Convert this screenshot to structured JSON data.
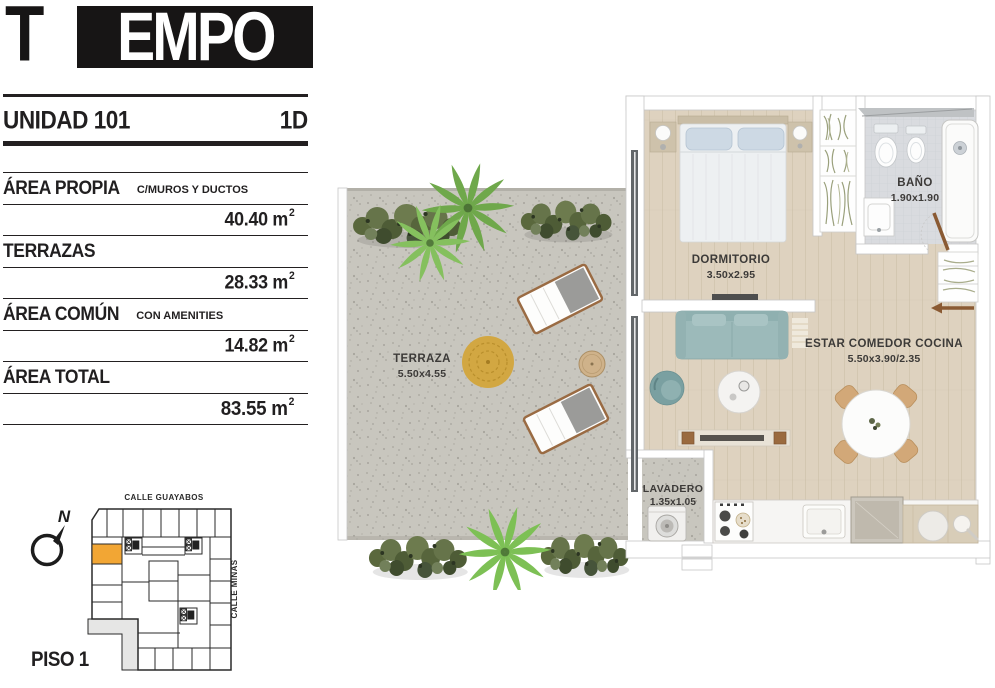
{
  "brand": {
    "logo_t": "T",
    "logo_box": "EMPO"
  },
  "unit": {
    "label": "UNIDAD 101",
    "type": "1D"
  },
  "area_rows": [
    {
      "label": "ÁREA PROPIA",
      "sublabel": "C/MUROS Y DUCTOS",
      "value": "40.40 m",
      "sup": "2"
    },
    {
      "label": "TERRAZAS",
      "sublabel": "",
      "value": "28.33 m",
      "sup": "2"
    },
    {
      "label": "ÁREA COMÚN",
      "sublabel": "CON AMENITIES",
      "value": "14.82 m",
      "sup": "2"
    },
    {
      "label": "ÁREA TOTAL",
      "sublabel": "",
      "value": "83.55 m",
      "sup": "2"
    }
  ],
  "rooms": {
    "terraza": {
      "name": "TERRAZA",
      "dims": "5.50x4.55"
    },
    "dormitorio": {
      "name": "DORMITORIO",
      "dims": "3.50x2.95"
    },
    "bano": {
      "name": "BAÑO",
      "dims": "1.90x1.90"
    },
    "estar": {
      "name": "ESTAR COMEDOR COCINA",
      "dims": "5.50x3.90/2.35"
    },
    "lavadero": {
      "name": "LAVADERO",
      "dims": "1.35x1.05"
    }
  },
  "keyplan": {
    "street_top": "CALLE GUAYABOS",
    "street_right": "CALLE MINAS",
    "floor": "PISO 1",
    "north": "N",
    "highlight_color": "#F2A634"
  },
  "colors": {
    "ink": "#232021",
    "accent_orange": "#F2A634",
    "wood_floor": "#DED2BF",
    "terrace_concrete": "#C8C6BE",
    "sofa_teal": "#9CBABA",
    "rug_gold": "#D2A742"
  }
}
